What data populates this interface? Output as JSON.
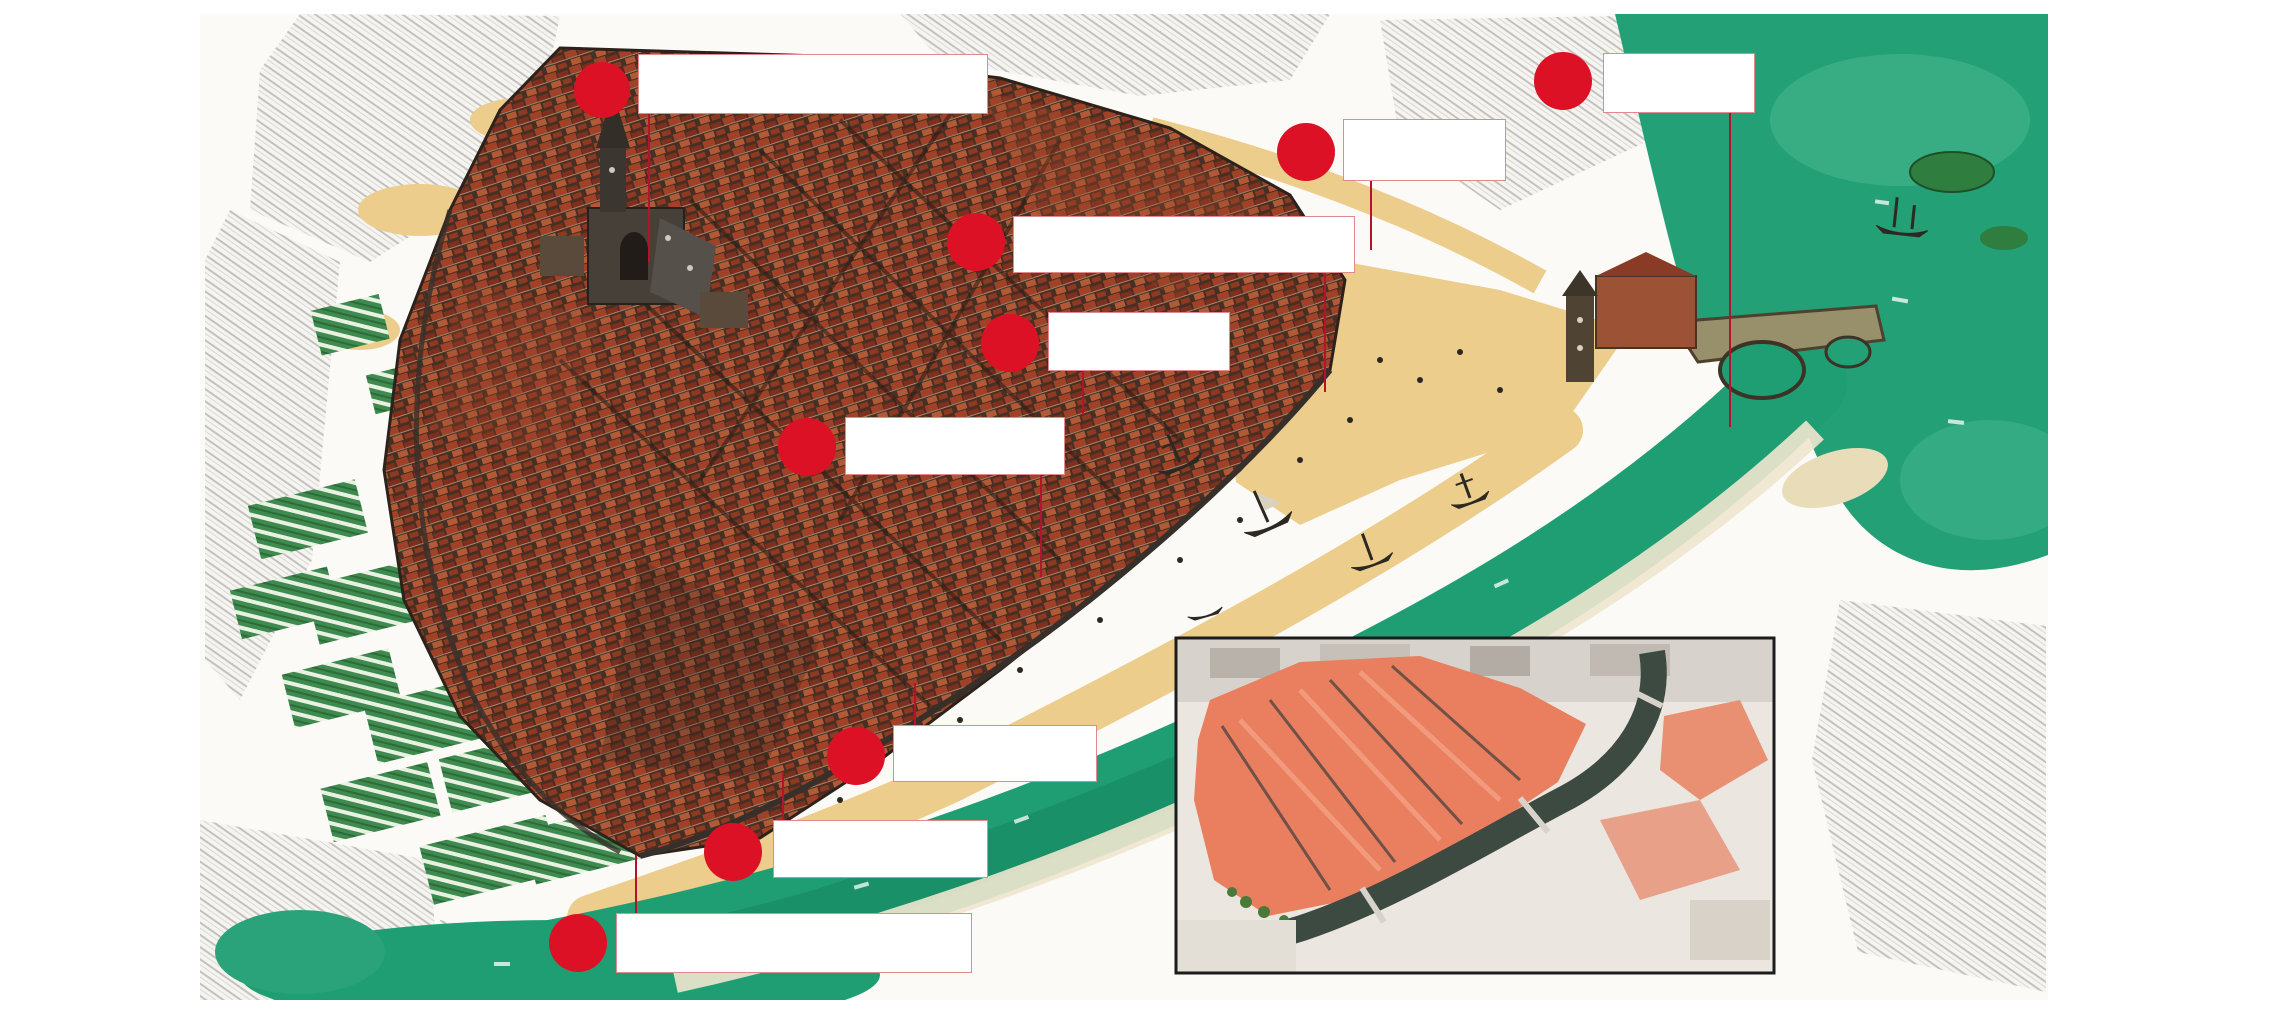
{
  "page": {
    "background": "#ffffff",
    "width": 2280,
    "height": 1032
  },
  "map": {
    "description": "watercolor-style illustrated bird's-eye map of a walled medieval river town",
    "x": 200,
    "y": 14,
    "w": 1848,
    "h": 986,
    "palette": {
      "water": "#1f9e74",
      "water_light": "#46b58d",
      "water_pool": "#23a076",
      "sand": "#eccd8b",
      "roof_dark": "#472f23",
      "roof_red": "#a04128",
      "field_green": "#3e8a4f",
      "sketch_gray": "#9b9b97",
      "wall_dark": "#37302a"
    },
    "marker_style": {
      "dot_color": "#dd1126",
      "leader_color": "#b5122d",
      "box_border_color": "#e08a8e",
      "box_fill": "#ffffff"
    },
    "markers": [
      {
        "id": 1,
        "label": "",
        "dot": {
          "cx": 602,
          "cy": 90,
          "r": 28
        },
        "box": {
          "x": 638,
          "y": 54,
          "w": 350,
          "h": 60
        },
        "leader": {
          "x": 649,
          "y1": 114,
          "y2": 262
        }
      },
      {
        "id": 2,
        "label": "",
        "dot": {
          "cx": 1306,
          "cy": 152,
          "r": 29
        },
        "box": {
          "x": 1343,
          "y": 119,
          "w": 163,
          "h": 62
        },
        "leader": {
          "x": 1371,
          "y1": 181,
          "y2": 250
        }
      },
      {
        "id": 3,
        "label": "",
        "dot": {
          "cx": 1563,
          "cy": 81,
          "r": 29
        },
        "box": {
          "x": 1603,
          "y": 53,
          "w": 152,
          "h": 60
        },
        "leader": {
          "x": 1730,
          "y1": 113,
          "y2": 427
        }
      },
      {
        "id": 4,
        "label": "",
        "dot": {
          "cx": 976,
          "cy": 242,
          "r": 29
        },
        "box": {
          "x": 1013,
          "y": 216,
          "w": 342,
          "h": 57
        },
        "leader": {
          "x": 1325,
          "y1": 273,
          "y2": 392
        }
      },
      {
        "id": 5,
        "label": "",
        "dot": {
          "cx": 1010,
          "cy": 343,
          "r": 29
        },
        "box": {
          "x": 1048,
          "y": 312,
          "w": 182,
          "h": 59
        },
        "leader": {
          "x": 1083,
          "y1": 371,
          "y2": 415
        }
      },
      {
        "id": 6,
        "label": "",
        "dot": {
          "cx": 807,
          "cy": 447,
          "r": 29
        },
        "box": {
          "x": 845,
          "y": 417,
          "w": 220,
          "h": 58
        },
        "leader": {
          "x": 1041,
          "y1": 475,
          "y2": 577
        }
      },
      {
        "id": 7,
        "label": "",
        "dot": {
          "cx": 856,
          "cy": 756,
          "r": 29
        },
        "box": {
          "x": 893,
          "y": 725,
          "w": 204,
          "h": 57
        },
        "leader": {
          "x": 915,
          "y1": 683,
          "y2": 725
        }
      },
      {
        "id": 8,
        "label": "",
        "dot": {
          "cx": 733,
          "cy": 852,
          "r": 29
        },
        "box": {
          "x": 773,
          "y": 820,
          "w": 215,
          "h": 58
        },
        "leader": {
          "x": 783,
          "y1": 772,
          "y2": 820
        }
      },
      {
        "id": 9,
        "label": "",
        "dot": {
          "cx": 578,
          "cy": 943,
          "r": 29
        },
        "box": {
          "x": 616,
          "y": 913,
          "w": 356,
          "h": 60
        },
        "leader": {
          "x": 636,
          "y1": 855,
          "y2": 913
        }
      }
    ]
  },
  "inset": {
    "x": 1176,
    "y": 638,
    "w": 598,
    "h": 335,
    "border_color": "#1c1c1c",
    "description": "modern aerial photo of the same old town, salmon rooftops ringed by dark river"
  }
}
